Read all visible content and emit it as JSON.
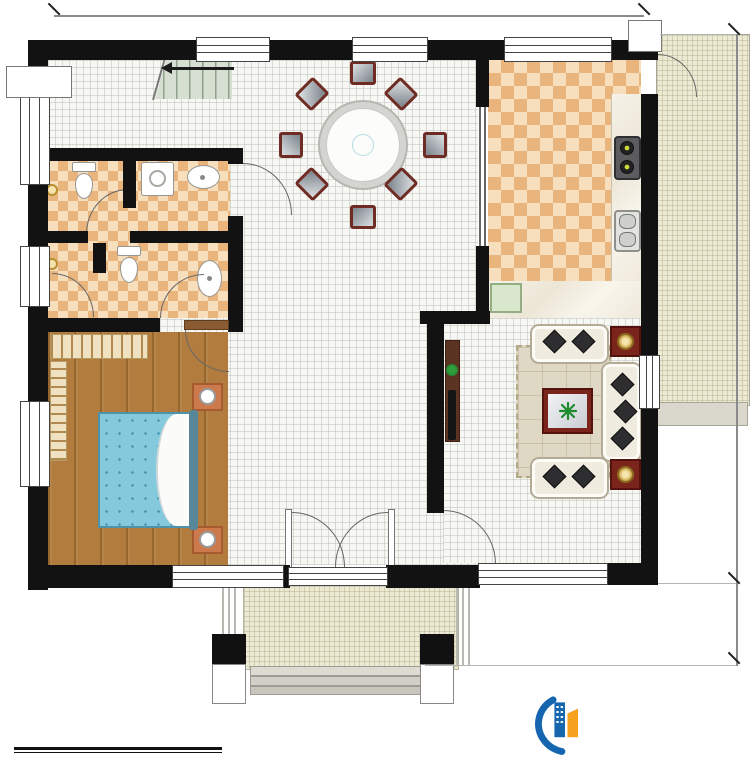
{
  "plan": {
    "rooms": {
      "stairwell": {
        "name": "楼梯间",
        "area": "9.07m²"
      },
      "public_bath": {
        "name": "公卫",
        "area": "2.81m²"
      },
      "laundry": {
        "name": "洗衣房",
        "area": "2.64m²"
      },
      "inner_bath": {
        "name": "内卫",
        "area": "4.42m²"
      },
      "store": {
        "area": "1.65m²"
      },
      "bedroom": {
        "name": "卧室",
        "area": "19.25m²"
      },
      "dining": {
        "name": "餐厅",
        "area": "26.05m²"
      },
      "kitchen": {
        "name": "厨房",
        "area": "16.40m²"
      },
      "drying_platform": {
        "name": "晾晒平台",
        "area": "5.50m²"
      },
      "living": {
        "name": "客厅",
        "area": "19.25m²"
      },
      "reception": {
        "name": "会客厅",
        "area": "19.25m²"
      },
      "porch": {
        "name": "入户门廊"
      }
    },
    "stairs_up_label": "上",
    "dimensions": {
      "top": "12600",
      "right": "10700",
      "porch": "1620"
    }
  },
  "notes": {
    "total_area": "本栋建筑面积：289.76m²",
    "floor_height": "层高：3.6m"
  },
  "titlebar": {
    "title": "一层平面图",
    "scale": "1:100",
    "floor_area": "本层建筑面积：144.88m²",
    "ground_area": "占地面积：164.65m²"
  },
  "brand": {
    "name": "柏竣建筑",
    "website": "www.baijunjz.com",
    "blue": "#1566ae",
    "orange": "#f6a21e"
  },
  "watermark": {
    "text": "柏竣建筑",
    "sub": "www.baijunjz.com"
  }
}
